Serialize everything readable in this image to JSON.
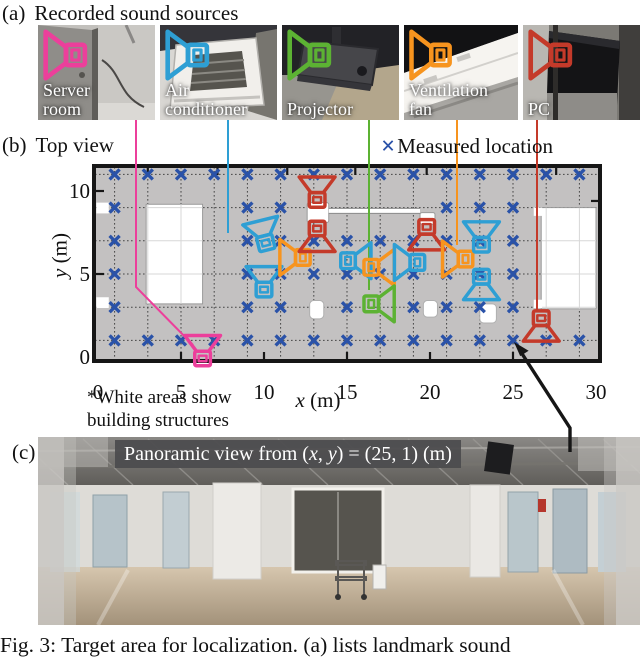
{
  "page": {
    "width": 640,
    "height": 657,
    "background": "#ffffff"
  },
  "colors": {
    "pink": "#ec3f9b",
    "blue": "#2e9fd4",
    "green": "#5cb233",
    "orange": "#f7941e",
    "red": "#c43a2a",
    "measured_x": "#2a52a8",
    "map_bg": "#c3c1c1",
    "map_border": "#161616",
    "caption_bar": "#4b4b4e"
  },
  "section_a": {
    "label": "(a)",
    "title": "Recorded sound sources",
    "photos": [
      {
        "name": "server-room",
        "label_lines": [
          "Server",
          "room"
        ],
        "color_key": "pink"
      },
      {
        "name": "air-conditioner",
        "label_lines": [
          "Air",
          "conditioner"
        ],
        "color_key": "blue"
      },
      {
        "name": "projector",
        "label_lines": [
          "Projector"
        ],
        "color_key": "green"
      },
      {
        "name": "ventilation-fan",
        "label_lines": [
          "Ventilation",
          "fan"
        ],
        "color_key": "orange"
      },
      {
        "name": "pc",
        "label_lines": [
          "PC"
        ],
        "color_key": "red"
      }
    ]
  },
  "section_b": {
    "label": "(b)",
    "title": "Top view",
    "legend_marker": "×",
    "legend_text": "Measured location",
    "note_line1": "*White areas show",
    "note_line2": "building structures",
    "xlabel_var": "x",
    "xlabel_unit": " (m)",
    "ylabel_var": "y",
    "ylabel_unit": " (m)"
  },
  "chart_data": {
    "type": "scatter",
    "title": "Top view",
    "xlabel": "x (m)",
    "ylabel": "y (m)",
    "xlim": [
      0,
      30
    ],
    "ylim": [
      -0.3,
      11.7
    ],
    "xticks": [
      0,
      5,
      10,
      15,
      20,
      25,
      30
    ],
    "yticks": [
      0,
      5,
      10
    ],
    "grid": "2 m dashed grid",
    "legend": [
      {
        "label": "Measured location",
        "marker": "x",
        "color_key": "measured_x"
      }
    ],
    "measured_rows": [
      {
        "y": 11,
        "xs": [
          1,
          3,
          5,
          7,
          9,
          11,
          13,
          15,
          17,
          19,
          21,
          23,
          25,
          27,
          29
        ]
      },
      {
        "y": 9,
        "xs": [
          1,
          9,
          11,
          21,
          23,
          25
        ]
      },
      {
        "y": 7,
        "xs": [
          1,
          9,
          11,
          13,
          15,
          17,
          19,
          21,
          23,
          25
        ]
      },
      {
        "y": 5,
        "xs": [
          1,
          9,
          11,
          13,
          15,
          17,
          19,
          21,
          23,
          25
        ]
      },
      {
        "y": 3,
        "xs": [
          1,
          9,
          11,
          15,
          19,
          21,
          23,
          25
        ]
      },
      {
        "y": 1,
        "xs": [
          1,
          3,
          5,
          7,
          9,
          11,
          13,
          15,
          17,
          19,
          21,
          23,
          25,
          27,
          29
        ]
      }
    ],
    "sound_sources": [
      {
        "source": "server-room",
        "color_key": "pink",
        "x": 6.3,
        "y": 0.35,
        "facing": "up"
      },
      {
        "source": "air-conditioner",
        "color_key": "blue",
        "x": 10.0,
        "y": 7.3,
        "facing": "up",
        "tilt": -14
      },
      {
        "source": "air-conditioner",
        "color_key": "blue",
        "x": 10.0,
        "y": 4.5,
        "facing": "up"
      },
      {
        "source": "ventilation-fan",
        "color_key": "orange",
        "x": 11.9,
        "y": 6.0,
        "facing": "left"
      },
      {
        "source": "pc",
        "color_key": "red",
        "x": 13.2,
        "y": 9.9,
        "facing": "up"
      },
      {
        "source": "pc",
        "color_key": "red",
        "x": 13.2,
        "y": 7.3,
        "facing": "down"
      },
      {
        "source": "air-conditioner",
        "color_key": "blue",
        "x": 15.5,
        "y": 5.8,
        "facing": "right"
      },
      {
        "source": "ventilation-fan",
        "color_key": "orange",
        "x": 16.9,
        "y": 5.4,
        "facing": "right"
      },
      {
        "source": "air-conditioner",
        "color_key": "blue",
        "x": 18.8,
        "y": 5.7,
        "facing": "left"
      },
      {
        "source": "projector",
        "color_key": "green",
        "x": 16.9,
        "y": 3.2,
        "facing": "right"
      },
      {
        "source": "pc",
        "color_key": "red",
        "x": 19.8,
        "y": 7.4,
        "facing": "down"
      },
      {
        "source": "ventilation-fan",
        "color_key": "orange",
        "x": 21.7,
        "y": 5.9,
        "facing": "left"
      },
      {
        "source": "air-conditioner",
        "color_key": "blue",
        "x": 23.1,
        "y": 7.2,
        "facing": "up"
      },
      {
        "source": "air-conditioner",
        "color_key": "blue",
        "x": 23.1,
        "y": 4.4,
        "facing": "down"
      },
      {
        "source": "pc",
        "color_key": "red",
        "x": 26.7,
        "y": 1.9,
        "facing": "down"
      }
    ],
    "structures": {
      "rooms": [
        {
          "x": 2.9,
          "y": 3.2,
          "w": 3.4,
          "h": 6.0
        },
        {
          "x": 26.7,
          "y": 2.9,
          "w": 3.3,
          "h": 6.1
        }
      ],
      "wall_boxes": [
        {
          "x": 12.6,
          "y": 8.1,
          "w": 1.3,
          "h": 1.2
        },
        {
          "x": 19.4,
          "y": 8.0,
          "w": 0.9,
          "h": 0.7
        }
      ],
      "wall_line": {
        "x1": 13.9,
        "y": 8.8,
        "x2": 19.4
      },
      "pillars": [
        {
          "x": 12.75,
          "y": 2.3,
          "w": 0.85,
          "h": 1.1
        },
        {
          "x": 19.6,
          "y": 2.4,
          "w": 0.85,
          "h": 1.0
        },
        {
          "x": 23.0,
          "y": 2.05,
          "w": 1.0,
          "h": 1.15
        }
      ],
      "notches": [
        {
          "x": -0.1,
          "y": 8.65,
          "w": 0.75,
          "h": 0.65
        },
        {
          "x": -0.1,
          "y": 2.95,
          "w": 0.75,
          "h": 0.65
        },
        {
          "x": 26.25,
          "y": 8.5,
          "w": 0.5,
          "h": 0.5
        },
        {
          "x": 26.25,
          "y": 2.95,
          "w": 0.5,
          "h": 0.5
        }
      ],
      "wall_ticks_top": [
        3,
        7.2,
        11.4,
        15.5,
        19.8,
        27.6
      ],
      "axis_ticks_bottom": [
        5,
        10,
        15,
        20,
        25
      ]
    },
    "callout_lines_px": [
      {
        "color_key": "pink",
        "points": [
          [
            136,
            120
          ],
          [
            136,
            287
          ],
          [
            193,
            345
          ]
        ]
      },
      {
        "color_key": "blue",
        "points": [
          [
            228,
            120
          ],
          [
            228,
            233
          ]
        ]
      },
      {
        "color_key": "green",
        "points": [
          [
            369,
            120
          ],
          [
            369,
            290
          ]
        ]
      },
      {
        "color_key": "orange",
        "points": [
          [
            457,
            120
          ],
          [
            457,
            245
          ]
        ]
      },
      {
        "color_key": "red",
        "points": [
          [
            537,
            120
          ],
          [
            537,
            311
          ]
        ]
      }
    ],
    "arrow": {
      "points_px": [
        [
          570,
          452
        ],
        [
          570,
          428
        ],
        [
          519,
          349
        ]
      ],
      "target_xy": [
        25,
        1
      ]
    }
  },
  "section_c": {
    "label": "(c)",
    "caption_prefix": "Panoramic view from (",
    "var_x": "x",
    "sep": ", ",
    "var_y": "y",
    "caption_suffix": ") = (25, 1) (m)"
  },
  "figure_caption": "Fig. 3: Target area for localization. (a) lists landmark sound"
}
